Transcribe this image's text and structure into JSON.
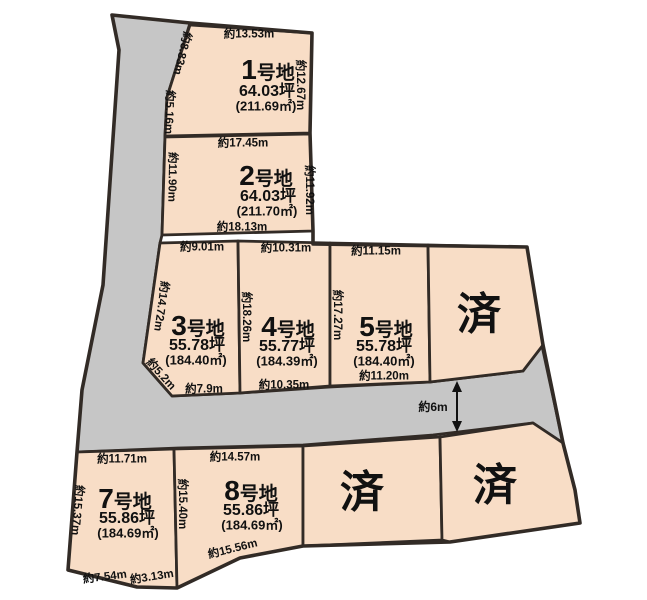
{
  "diagram": {
    "sold_mark": "済",
    "road_width_label": "約6m",
    "colors": {
      "plot_fill": "#f8ddc6",
      "road_fill": "#c6c6c6",
      "line": "#322b26"
    },
    "plots": {
      "p1": {
        "num": "1",
        "suffix": "号地",
        "tsubo": "64.03坪",
        "sqm": "(211.69㎡)",
        "edge_top": "約13.53m",
        "edge_left_upper": "約8.83m",
        "edge_left_lower": "約5.16m",
        "edge_right": "約12.67m"
      },
      "p2": {
        "num": "2",
        "suffix": "号地",
        "tsubo": "64.03坪",
        "sqm": "(211.70㎡)",
        "edge_top": "約17.45m",
        "edge_left": "約11.90m",
        "edge_right": "約11.92m",
        "edge_bottom": "約18.13m"
      },
      "p3": {
        "num": "3",
        "suffix": "号地",
        "tsubo": "55.78坪",
        "sqm": "(184.40㎡)",
        "edge_top": "約9.01m",
        "edge_left": "約14.72m",
        "edge_right": "約18.26m",
        "edge_corner": "約5.2m",
        "edge_bottom": "約7.9m"
      },
      "p4": {
        "num": "4",
        "suffix": "号地",
        "tsubo": "55.77坪",
        "sqm": "(184.39㎡)",
        "edge_top": "約10.31m",
        "edge_bottom": "約10.35m"
      },
      "p5": {
        "num": "5",
        "suffix": "号地",
        "tsubo": "55.78坪",
        "sqm": "(184.40㎡)",
        "edge_top": "約11.15m",
        "edge_left": "約17.27m",
        "edge_bottom": "約11.20m"
      },
      "p7": {
        "num": "7",
        "suffix": "号地",
        "tsubo": "55.86坪",
        "sqm": "(184.69㎡)",
        "edge_top": "約11.71m",
        "edge_left": "約15.37m",
        "edge_bottom_left": "約7.54m",
        "edge_bottom_right": "約3.13m"
      },
      "p8": {
        "num": "8",
        "suffix": "号地",
        "tsubo": "55.86坪",
        "sqm": "(184.69㎡)",
        "edge_top": "約14.57m",
        "edge_left": "約15.40m",
        "edge_bottom": "約15.56m"
      }
    }
  }
}
